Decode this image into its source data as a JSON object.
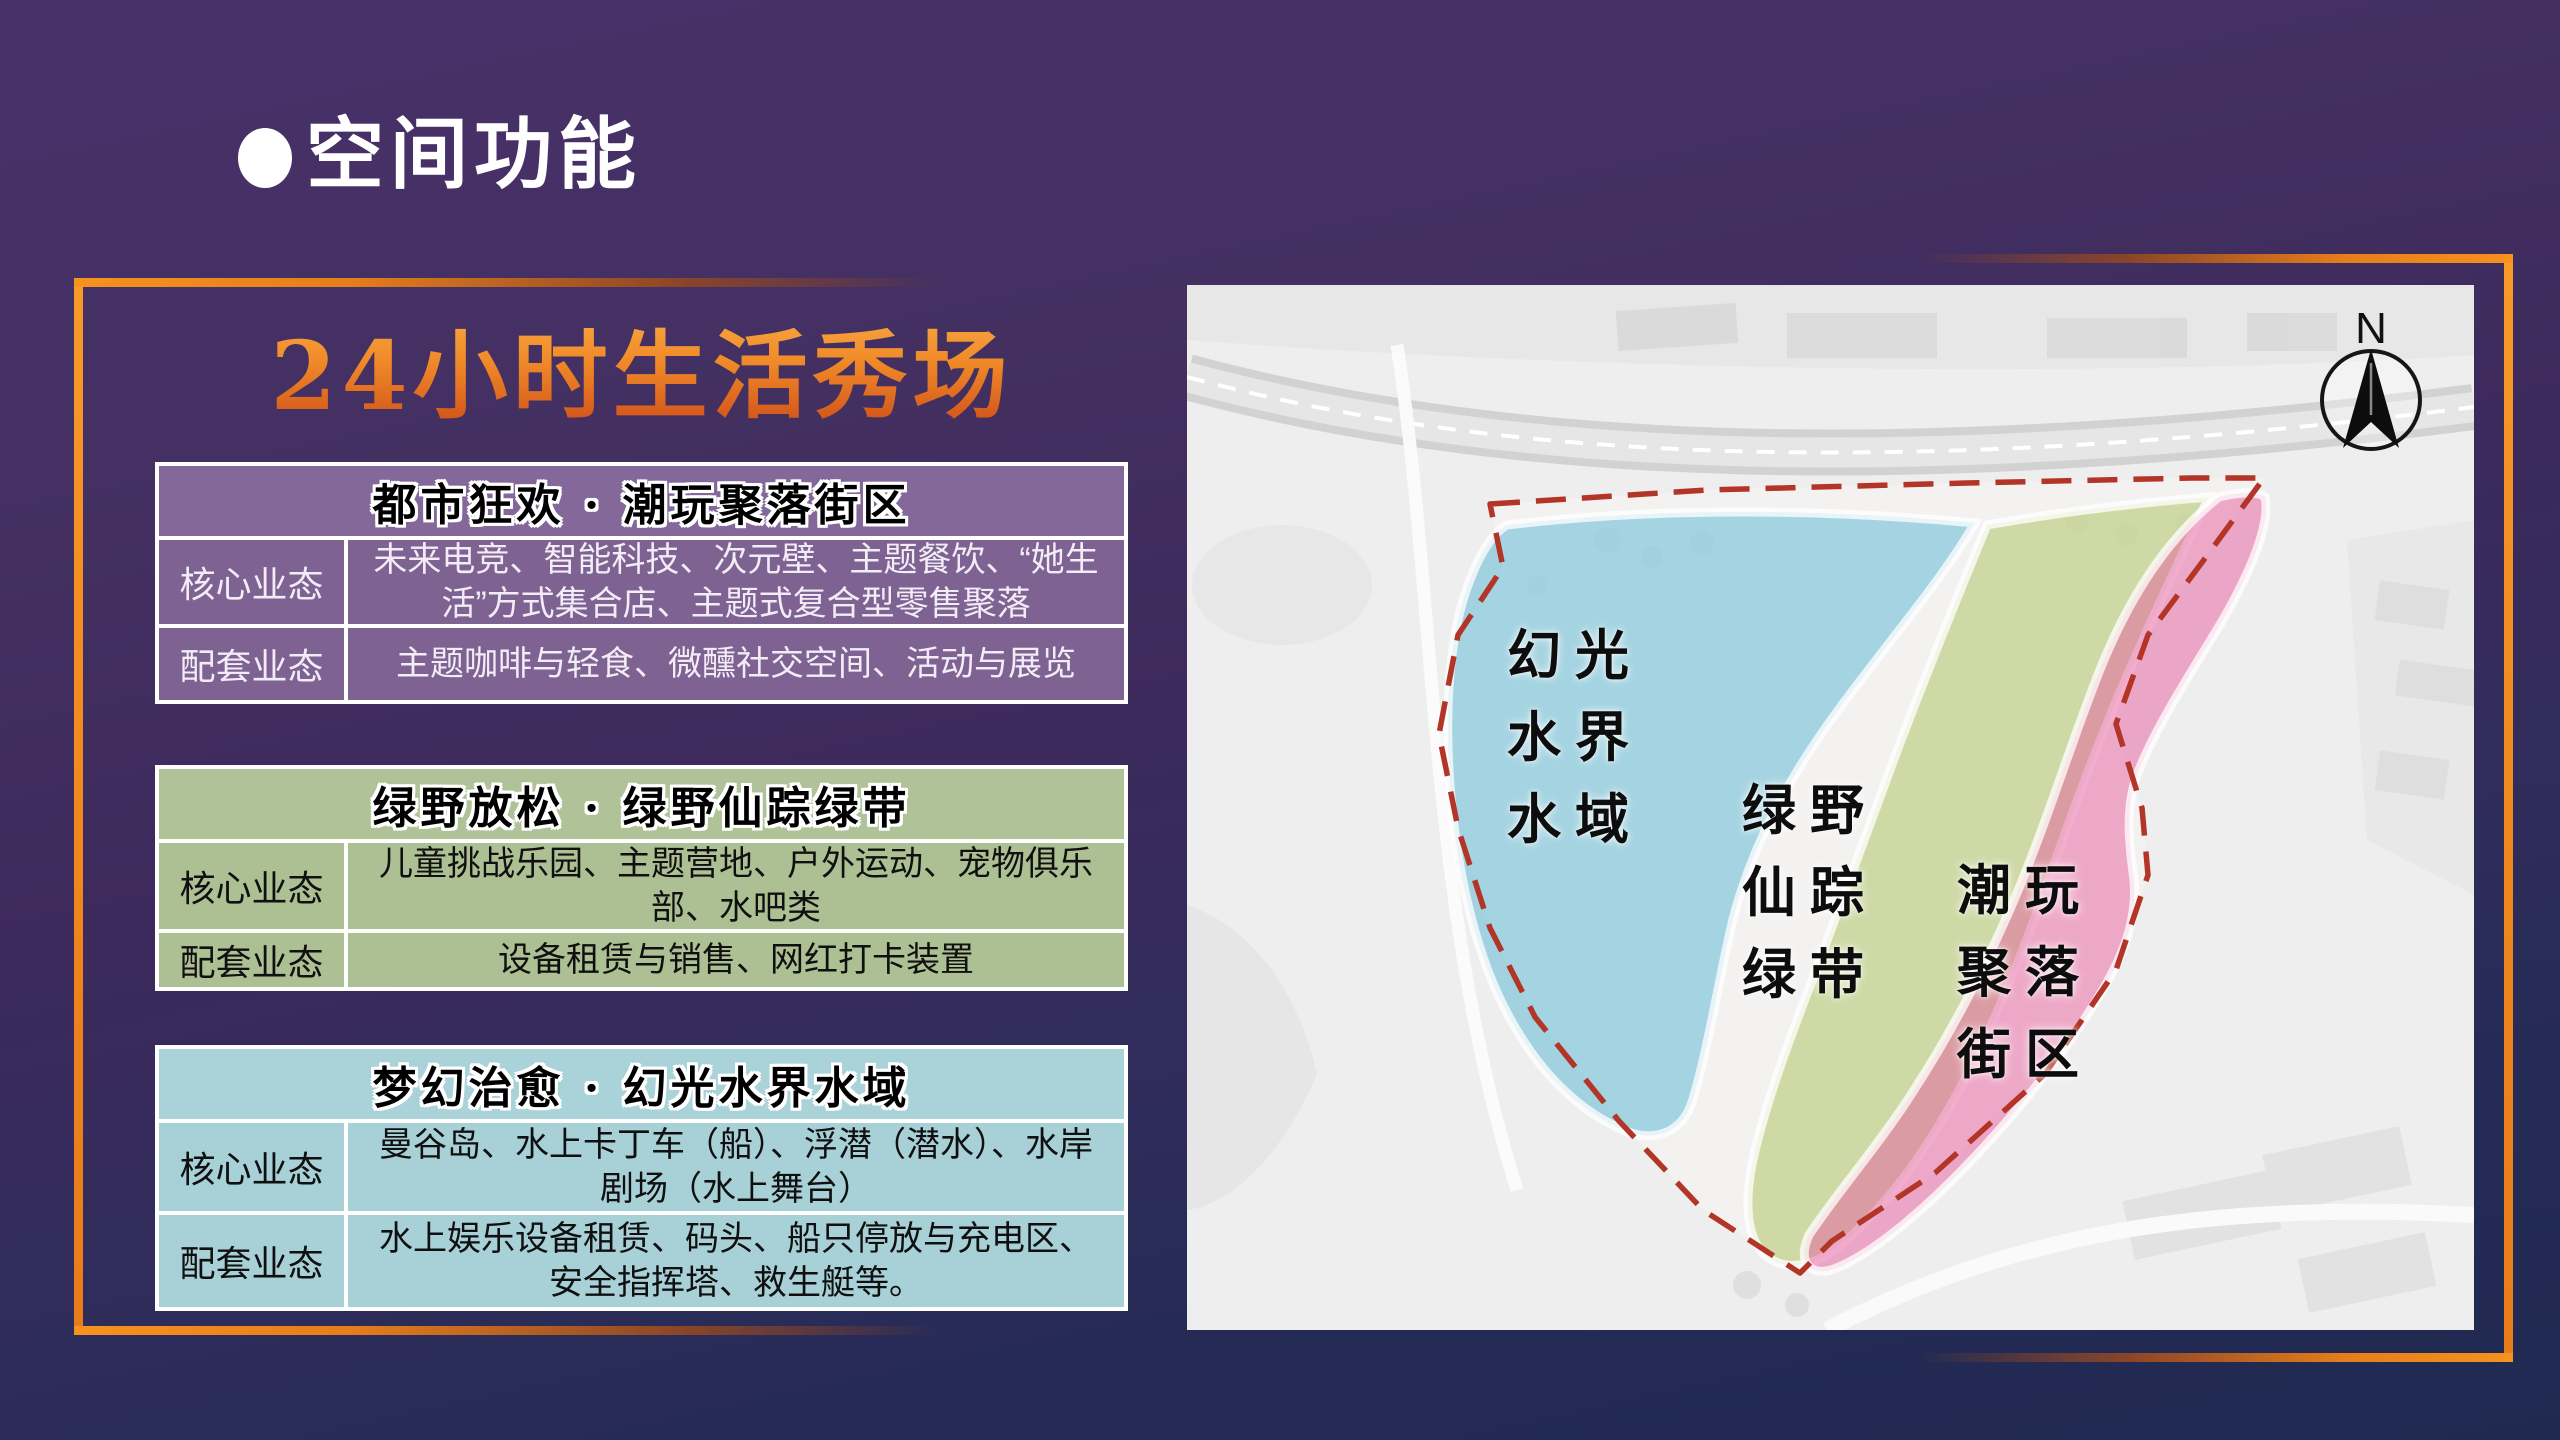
{
  "slide": {
    "section_title": "空间功能",
    "headline": "24小时生活秀场"
  },
  "tables": [
    {
      "title": "都市狂欢 · 潮玩聚落街区",
      "colors": {
        "header_bg": "#84689a",
        "body_bg": "#7d6292",
        "text": "#f2ecf6",
        "header_text": "#000000"
      },
      "rows": [
        {
          "label": "核心业态",
          "content": "未来电竞、智能科技、次元壁、主题餐饮、“她生活”方式集合店、主题式复合型零售聚落"
        },
        {
          "label": "配套业态",
          "content": "主题咖啡与轻食、微醺社交空间、活动与展览"
        }
      ]
    },
    {
      "title": "绿野放松 · 绿野仙踪绿带",
      "colors": {
        "header_bg": "#b0c297",
        "body_bg": "#adc094",
        "text": "#101010",
        "header_text": "#000000"
      },
      "rows": [
        {
          "label": "核心业态",
          "content": "儿童挑战乐园、主题营地、户外运动、宠物俱乐部、水吧类"
        },
        {
          "label": "配套业态",
          "content": "设备租赁与销售、网红打卡装置"
        }
      ]
    },
    {
      "title": "梦幻治愈 · 幻光水界水域",
      "colors": {
        "header_bg": "#a9d2d9",
        "body_bg": "#a7d0d7",
        "text": "#101010",
        "header_text": "#000000"
      },
      "rows": [
        {
          "label": "核心业态",
          "content": "曼谷岛、水上卡丁车（船）、浮潜（潜水）、水岸剧场（水上舞台）"
        },
        {
          "label": "配套业态",
          "content": "水上娱乐设备租赁、码头、船只停放与充电区、安全指挥塔、救生艇等。"
        }
      ]
    }
  ],
  "map": {
    "compass_label": "N",
    "boundary_color": "#b23527",
    "zones": [
      {
        "name": "幻光水界水域",
        "lines": [
          "幻光",
          "水界",
          "水域"
        ],
        "color": "#55b4d2"
      },
      {
        "name": "绿野仙踪绿带",
        "lines": [
          "绿野",
          "仙踪",
          "绿带"
        ],
        "color": "#a9bf5b"
      },
      {
        "name": "潮玩聚落街区",
        "lines": [
          "潮玩",
          "聚落",
          "街区"
        ],
        "color": "#e75d9f"
      }
    ]
  },
  "accents": {
    "frame_orange": "#f1881e",
    "headline_top": "#f9ad49",
    "headline_bottom": "#cc4718",
    "background_top": "#46306a",
    "background_bottom": "#202a51"
  }
}
